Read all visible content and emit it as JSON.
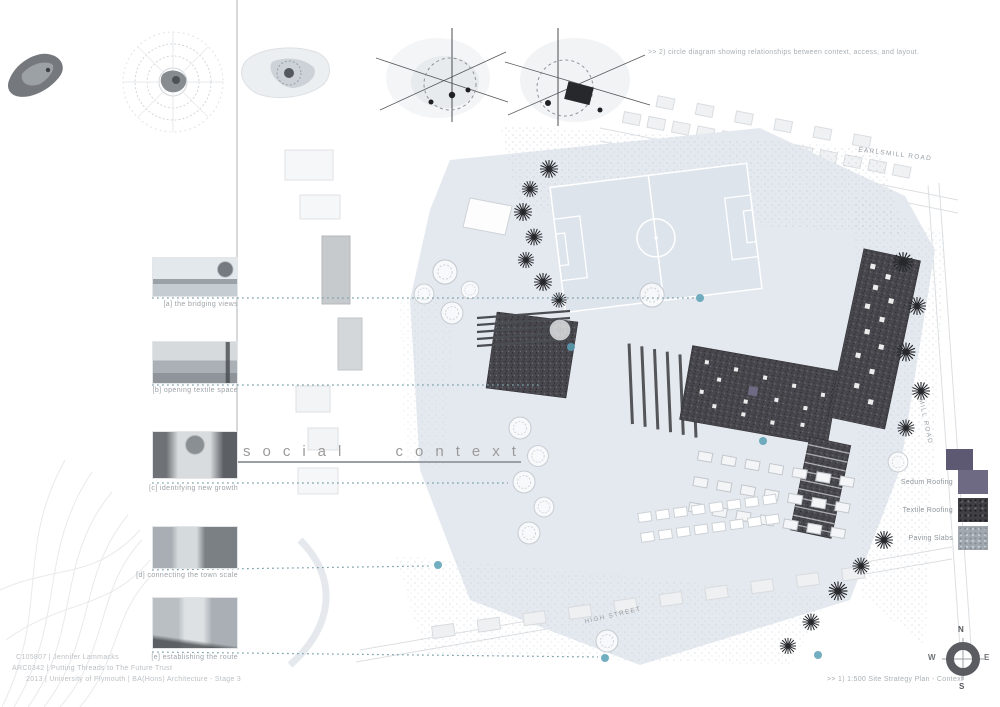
{
  "board": {
    "title": "social context",
    "annotation_top": ">> 2) circle diagram showing relationships between context, access, and layout.",
    "annotation_bottom": ">> 1) 1:500 Site Strategy Plan - Context",
    "credits": [
      "C105807 | Jennifer Lammacks",
      "ARC0342 | Putting Threads to The Future Trust",
      "2013 | University of Plymouth | BA(Hons) Architecture - Stage 3"
    ]
  },
  "photos": [
    {
      "caption": "[a] the bridging views"
    },
    {
      "caption": "[b] opening textile space"
    },
    {
      "caption": "[c] identifying new growth"
    },
    {
      "caption": "[d] connecting the town scale"
    },
    {
      "caption": "[e] establishing the route"
    }
  ],
  "legend": {
    "items": [
      {
        "label": "Sedum Roofing",
        "color": "#6e6a84"
      },
      {
        "label": "Textile Roofing",
        "color": "#3f3f44"
      },
      {
        "label": "Paving Slabs",
        "color": "#a2a8af"
      }
    ]
  },
  "roads": [
    {
      "label": "EARLSMILL ROAD"
    },
    {
      "label": "HIGH STREET"
    },
    {
      "label": "MILL ROAD"
    }
  ],
  "compass": {
    "north": "N",
    "east": "E",
    "south": "S",
    "west": "W"
  },
  "colors": {
    "accent_teal": "#58a0b4",
    "sedum_purple": "#6e6a84",
    "line_gray": "#9aa0a5"
  }
}
